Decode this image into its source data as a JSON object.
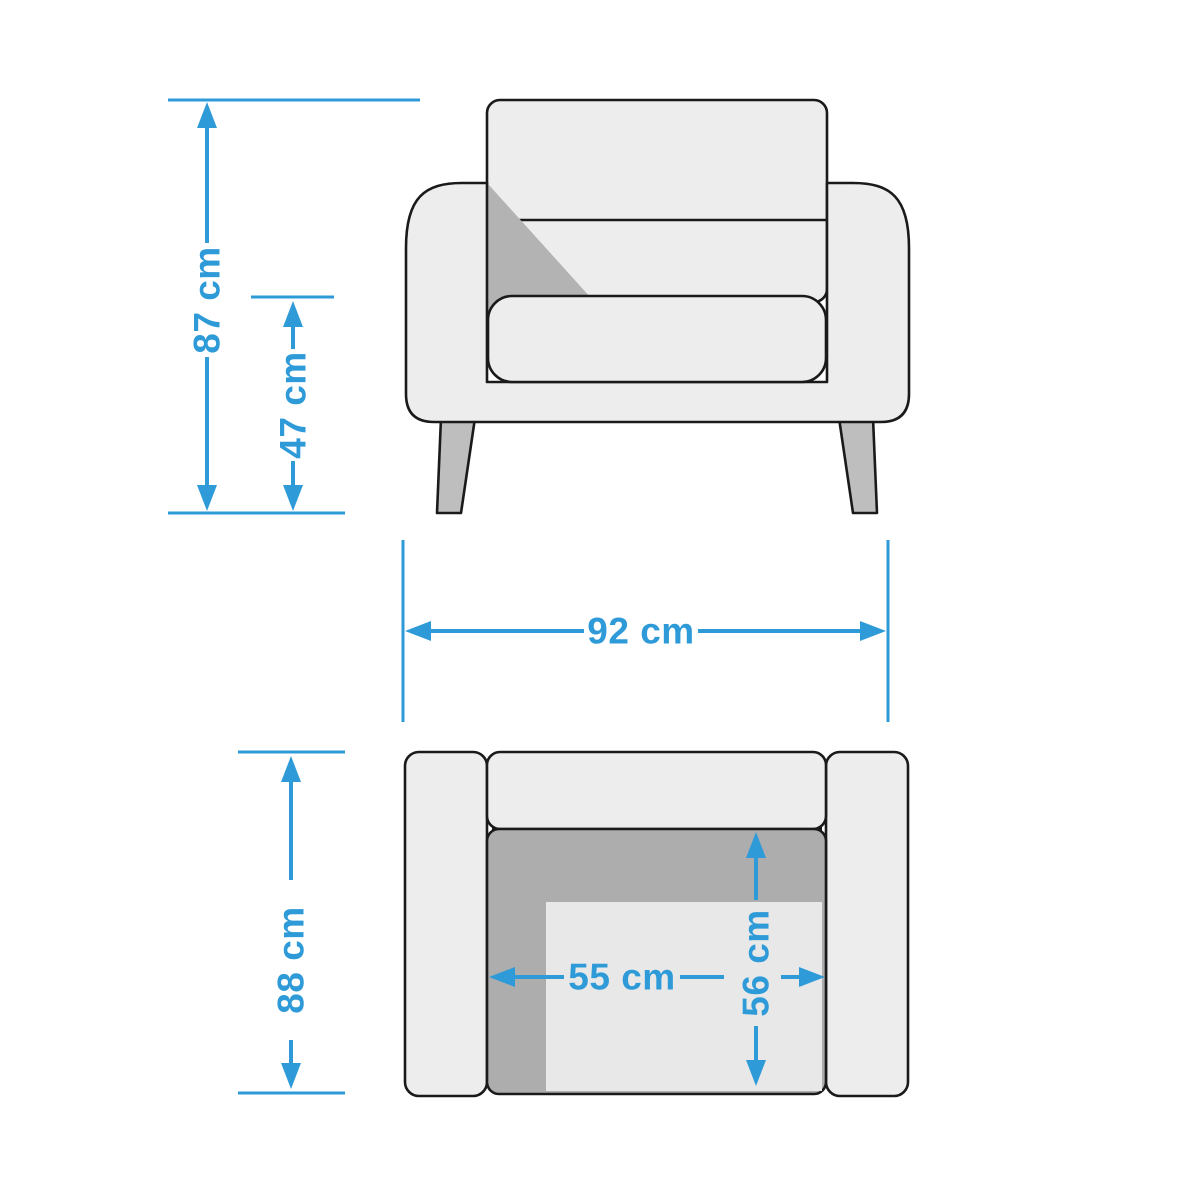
{
  "diagram": {
    "unit": "cm",
    "dimensions": {
      "overall_height": "87 cm",
      "seat_height": "47 cm",
      "overall_width": "92 cm",
      "overall_depth": "88 cm",
      "seat_width": "55 cm",
      "seat_depth": "56 cm"
    },
    "colors": {
      "accent_blue": "#2E9BD8",
      "outline": "#1A1A1A",
      "body_fill": "#EDEDED",
      "shadow_fill": "#B3B3B3",
      "seat_dark_fill": "#ADADAD",
      "seat_inner_fill": "#E8E8E8",
      "leg_fill": "#BEBEBE",
      "background": "#FFFFFF"
    }
  }
}
